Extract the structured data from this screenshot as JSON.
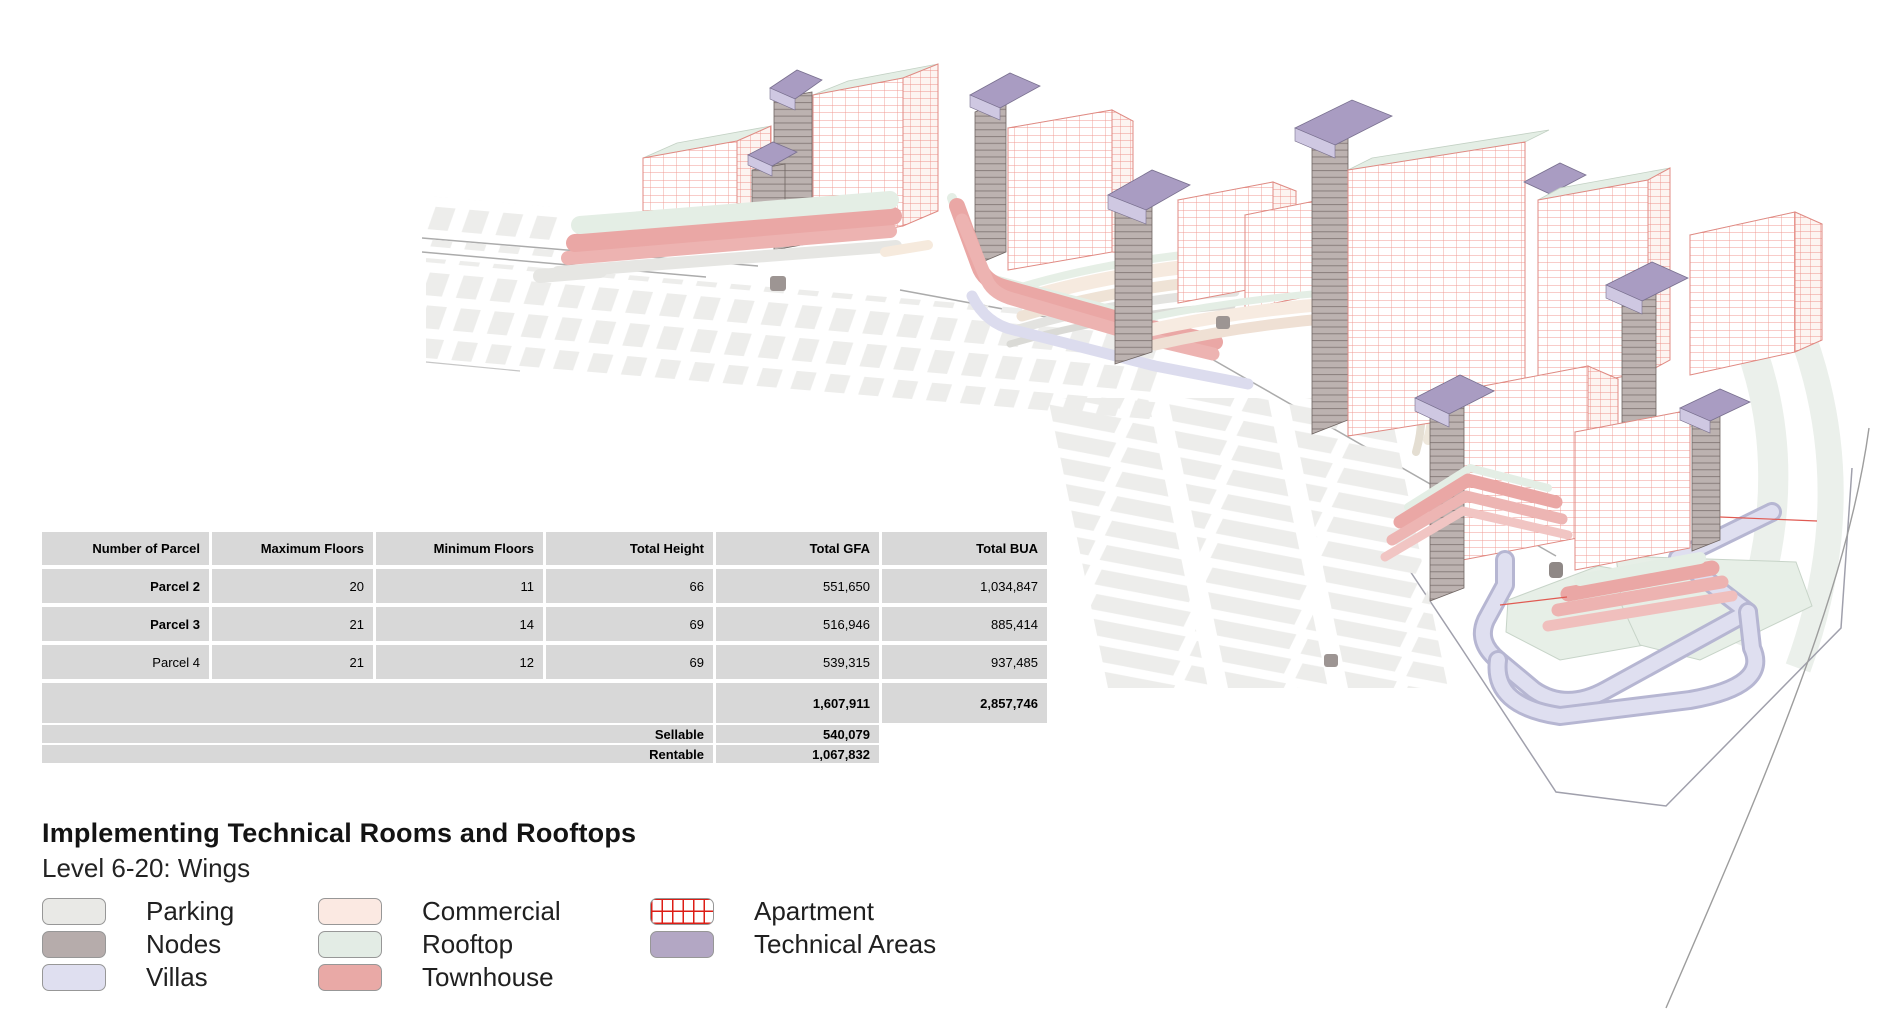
{
  "title": "Implementing Technical Rooms and Rooftops",
  "subtitle": "Level 6-20: Wings",
  "table": {
    "headers": [
      "Number of Parcel",
      "Maximum Floors",
      "Minimum Floors",
      "Total Height",
      "Total GFA",
      "Total BUA"
    ],
    "rows": [
      [
        "Parcel 2",
        "20",
        "11",
        "66",
        "551,650",
        "1,034,847"
      ],
      [
        "Parcel 3",
        "21",
        "14",
        "69",
        "516,946",
        "885,414"
      ],
      [
        "Parcel 4",
        "21",
        "12",
        "69",
        "539,315",
        "937,485"
      ]
    ],
    "totals": {
      "total_gfa": "1,607,911",
      "total_bua": "2,857,746"
    },
    "sellable": {
      "label": "Sellable",
      "value": "540,079"
    },
    "rentable": {
      "label": "Rentable",
      "value": "1,067,832"
    }
  },
  "legend": {
    "items": [
      {
        "label": "Parking",
        "color": "#e9e9e6"
      },
      {
        "label": "Nodes",
        "color": "#b6acab"
      },
      {
        "label": "Villas",
        "color": "#dfdff0"
      },
      {
        "label": "Commercial",
        "color": "#fbe9e2"
      },
      {
        "label": "Rooftop",
        "color": "#e3ece5"
      },
      {
        "label": "Townhouse",
        "color": "#e9a9a6"
      },
      {
        "label": "Apartment",
        "color": "#ffffff",
        "grid_color": "#dd1d15"
      },
      {
        "label": "Technical Areas",
        "color": "#b3a7c4"
      }
    ]
  }
}
